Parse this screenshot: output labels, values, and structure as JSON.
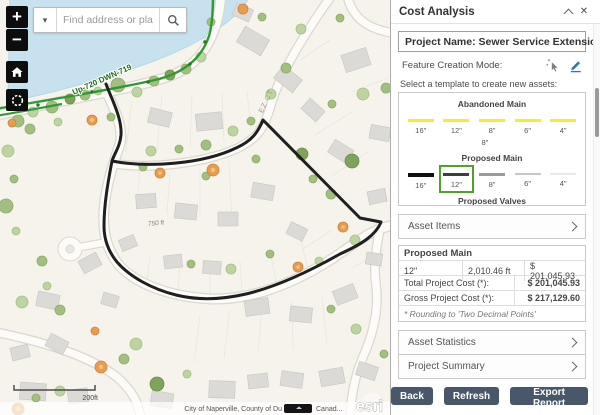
{
  "map": {
    "search": {
      "placeholder": "Find address or place"
    },
    "controls": {
      "zoom_in": "+",
      "zoom_out": "−"
    },
    "labels": {
      "sewer_line": "Up-720 DWN-719",
      "street": "EZ CT",
      "distance": "750 ft",
      "scale": "200ft",
      "attribution_left": "City of Naperville, County of Du",
      "attribution_right": "Canad...",
      "esri_logo": "esri"
    }
  },
  "panel": {
    "title": "Cost Analysis",
    "project_name": "Project Name: Sewer Service Extension",
    "feature_creation_mode_label": "Feature Creation Mode:",
    "select_template_label": "Select a template to create new assets:",
    "groups": {
      "abandoned": {
        "title": "Abandoned Main",
        "color": "#f2ef2a",
        "items": [
          "16\"",
          "12\"",
          "8\"",
          "6\"",
          "4\""
        ],
        "wrapped_item": "8\""
      },
      "proposed": {
        "title": "Proposed Main",
        "highlight": "#53a02f",
        "items": [
          {
            "size": "16\"",
            "color": "#101010"
          },
          {
            "size": "12\"",
            "color": "#3e3e3e",
            "selected": true
          },
          {
            "size": "8\"",
            "color": "#9b9b9b"
          },
          {
            "size": "6\"",
            "color": "#c6c6c6"
          },
          {
            "size": "4\"",
            "color": "#e9e9e9"
          }
        ]
      },
      "valves": {
        "title": "Proposed Valves"
      }
    },
    "sections": {
      "asset_items": "Asset Items",
      "asset_statistics": "Asset Statistics",
      "project_summary": "Project Summary"
    },
    "table": {
      "group_header": "Proposed Main",
      "rows": [
        {
          "size": "12\"",
          "length": "2,010.46 ft",
          "cost": "$ 201,045.93"
        }
      ],
      "total_label": "Total Project Cost (*):",
      "total_value": "$ 201,045.93",
      "gross_label": "Gross Project Cost (*):",
      "gross_value": "$ 217,129.60",
      "note": "* Rounding to 'Two Decimal Points'"
    },
    "buttons": {
      "back": "Back",
      "refresh": "Refresh",
      "export": "Export Report"
    }
  }
}
